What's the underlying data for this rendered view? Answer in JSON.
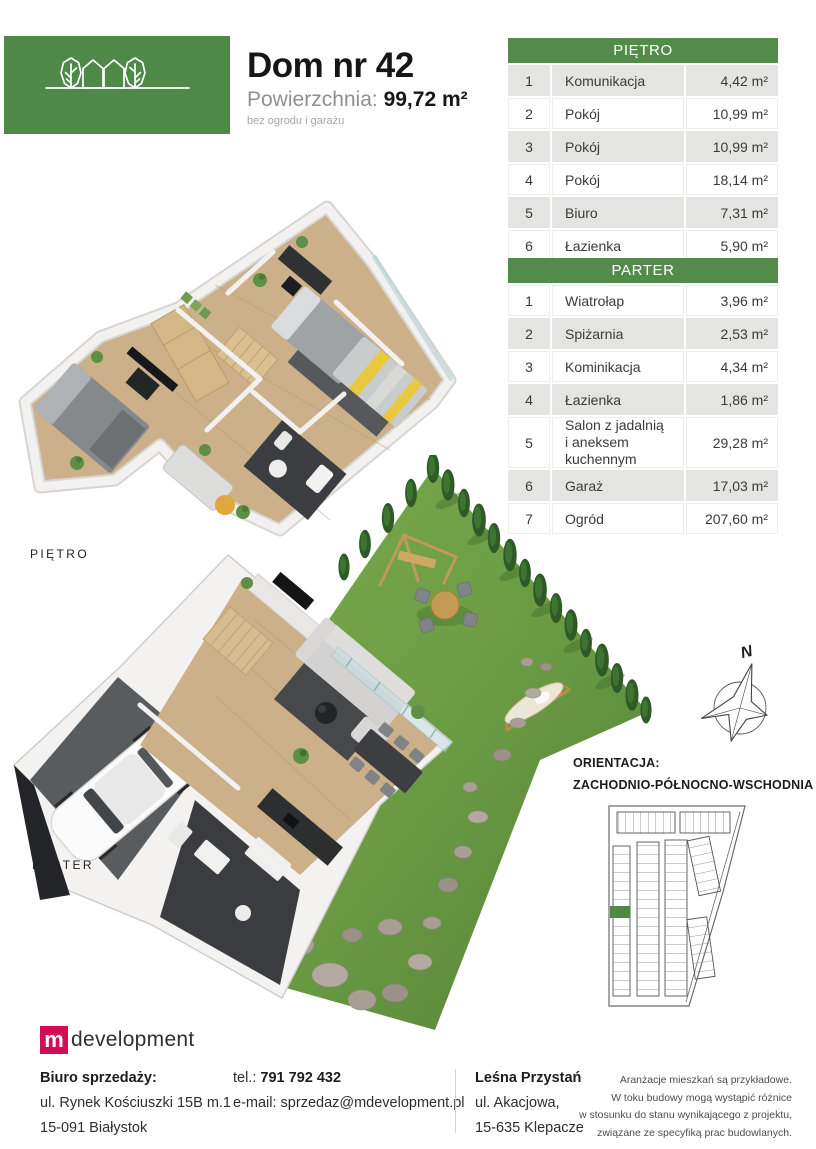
{
  "header": {
    "brand_name": "LEŚNA PRZYSTAŃ",
    "title": "Dom nr 42",
    "area_label": "Powierzchnia:",
    "area_value": "99,72 m²",
    "area_note": "bez ogrodu i garażu"
  },
  "tables": {
    "pietro": {
      "header": "PIĘTRO",
      "rows": [
        {
          "no": "1",
          "name": "Komunikacja",
          "area": "4,42 m²"
        },
        {
          "no": "2",
          "name": "Pokój",
          "area": "10,99 m²"
        },
        {
          "no": "3",
          "name": "Pokój",
          "area": "10,99 m²"
        },
        {
          "no": "4",
          "name": "Pokój",
          "area": "18,14 m²"
        },
        {
          "no": "5",
          "name": "Biuro",
          "area": "7,31 m²"
        },
        {
          "no": "6",
          "name": "Łazienka",
          "area": "5,90 m²"
        }
      ]
    },
    "parter": {
      "header": "PARTER",
      "rows": [
        {
          "no": "1",
          "name": "Wiatrołap",
          "area": "3,96 m²"
        },
        {
          "no": "2",
          "name": "Spiżarnia",
          "area": "2,53 m²"
        },
        {
          "no": "3",
          "name": "Kominikacja",
          "area": "4,34 m²"
        },
        {
          "no": "4",
          "name": "Łazienka",
          "area": "1,86 m²"
        },
        {
          "no": "5",
          "name": "Salon z jadalnią",
          "name2": "i aneksem kuchennym",
          "area": "29,28 m²"
        },
        {
          "no": "6",
          "name": "Garaż",
          "area": "17,03 m²"
        },
        {
          "no": "7",
          "name": "Ogród",
          "area": "207,60 m²"
        }
      ]
    }
  },
  "plans": {
    "pietro_label": "PIĘTRO",
    "parter_label": "PARTER"
  },
  "orientation": {
    "compass_letter": "N",
    "label": "ORIENTACJA:",
    "value": "ZACHODNIO-PÓŁNOCNO-WSCHODNIA"
  },
  "footer": {
    "logo_m": "m",
    "logo_text": "development",
    "office": {
      "label": "Biuro sprzedaży:",
      "line1": "ul. Rynek Kościuszki 15B m.1",
      "line2": "15-091 Białystok"
    },
    "contact": {
      "tel_label": "tel.:",
      "tel_value": "791 792 432",
      "email_label": "e-mail:",
      "email_value": "sprzedaz@mdevelopment.pl"
    },
    "estate": {
      "name": "Leśna Przystań",
      "line1": "ul. Akacjowa,",
      "line2": "15-635 Klepacze"
    },
    "disclaimer": {
      "l1": "Aranżacje mieszkań są przykładowe.",
      "l2": "W toku budowy mogą wystąpić różnice",
      "l3": "w stosunku do stanu wynikającego z projektu,",
      "l4": "związane ze specyfiką prac budowlanych."
    }
  },
  "colors": {
    "brand_green": "#4f8947",
    "table_header_green": "#538c4a",
    "row_gray": "#e4e4e2",
    "logo_red": "#d40e56",
    "sitemap_highlight_green": "#4e8a44"
  }
}
